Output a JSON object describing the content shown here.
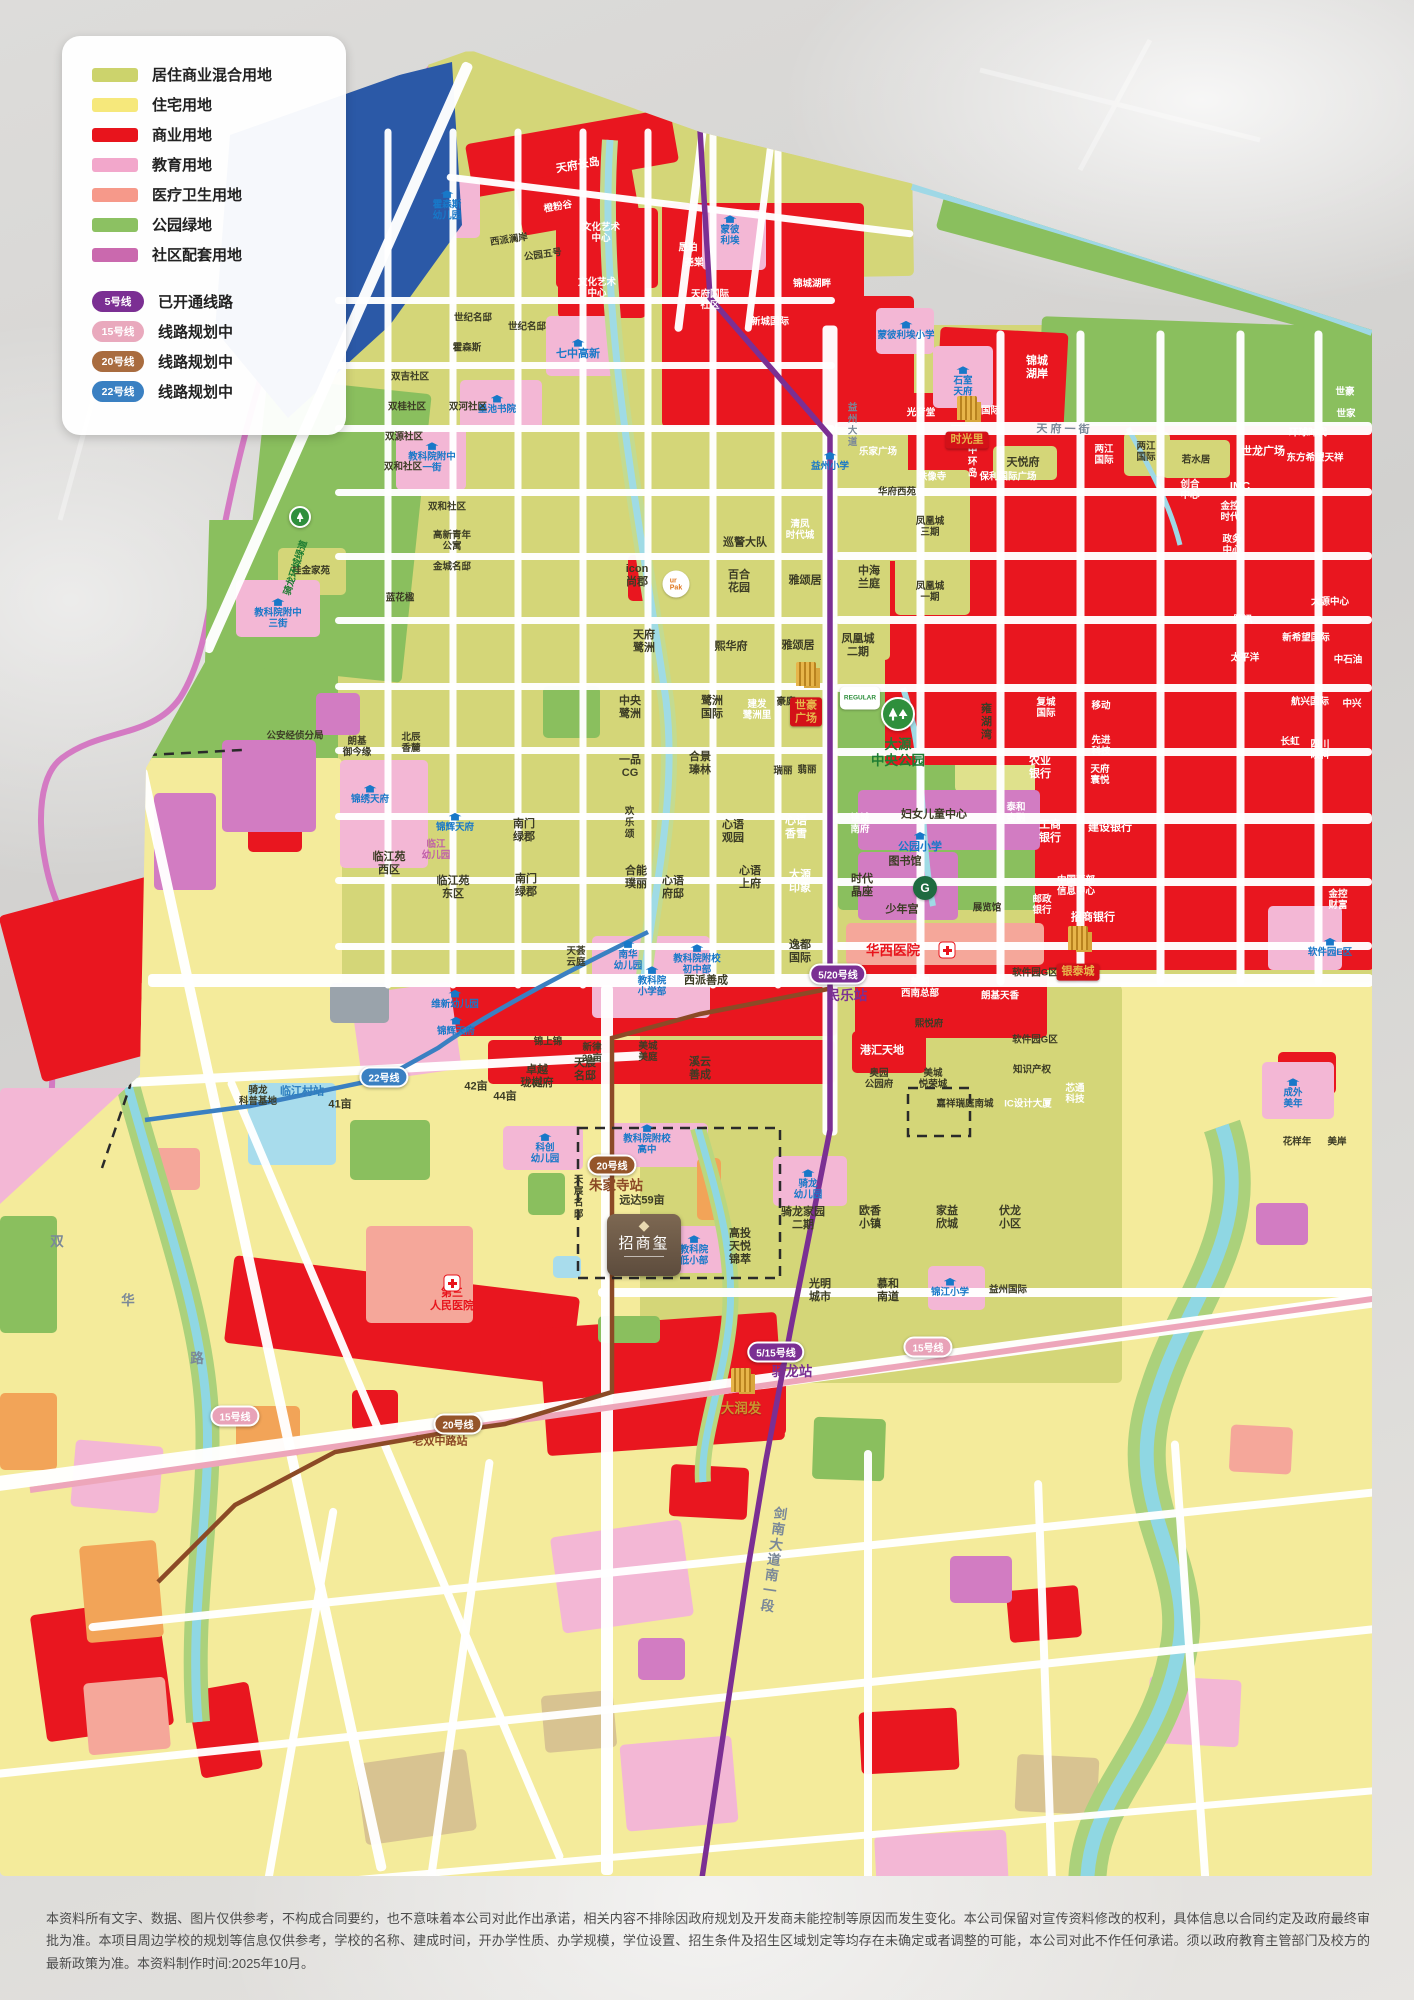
{
  "legend": {
    "land_use": [
      {
        "label": "居住商业混合用地",
        "color": "#ccd36c"
      },
      {
        "label": "住宅用地",
        "color": "#f6e87b"
      },
      {
        "label": "商业用地",
        "color": "#e8141c"
      },
      {
        "label": "教育用地",
        "color": "#f2a7cb"
      },
      {
        "label": "医疗卫生用地",
        "color": "#f6998a"
      },
      {
        "label": "公园绿地",
        "color": "#8cc162"
      },
      {
        "label": "社区配套用地",
        "color": "#ca69ae"
      }
    ],
    "metro": [
      {
        "badge": "5号线",
        "color": "#7b2f93",
        "label": "已开通线路"
      },
      {
        "badge": "15号线",
        "color": "#e9a9bd",
        "label": "线路规划中"
      },
      {
        "badge": "20号线",
        "color": "#a96c3f",
        "label": "线路规划中"
      },
      {
        "badge": "22号线",
        "color": "#3a80c2",
        "label": "线路规划中"
      }
    ]
  },
  "stations": [
    {
      "line": "5/20号线",
      "x": 838,
      "y": 974,
      "color": "#7b2f93"
    },
    {
      "line": "5/15号线",
      "x": 776,
      "y": 1352,
      "color": "#7b2f93"
    },
    {
      "line": "20号线",
      "x": 612,
      "y": 1165,
      "color": "#95552a"
    },
    {
      "line": "20号线",
      "x": 458,
      "y": 1424,
      "color": "#95552a"
    },
    {
      "line": "22号线",
      "x": 384,
      "y": 1077,
      "color": "#3a80c2"
    },
    {
      "line": "15号线",
      "x": 235,
      "y": 1416,
      "color": "#e8a2b8"
    },
    {
      "line": "15号线",
      "x": 928,
      "y": 1347,
      "color": "#e8a2b8"
    }
  ],
  "landmarks": {
    "zhaoshangxi": "招商玺",
    "zsx_dia": "◆",
    "shihao": "世豪\n广场",
    "shiguangli": "时光里",
    "yintai": "银泰城",
    "regular": "REGULAR",
    "urpak": "ur\nPak",
    "gspace": "G"
  },
  "labels": [
    {
      "t": "天府长岛",
      "x": 578,
      "y": 166,
      "c": "w",
      "r": -10
    },
    {
      "t": "橙粉谷",
      "x": 558,
      "y": 207,
      "c": "w sm",
      "r": -10
    },
    {
      "t": "文化艺术\n中心",
      "x": 601,
      "y": 233,
      "c": "w sm"
    },
    {
      "t": "文化艺术\n中心",
      "x": 597,
      "y": 288,
      "c": "w sm"
    },
    {
      "t": "西派澜岸",
      "x": 509,
      "y": 240,
      "c": "sm",
      "r": -8
    },
    {
      "t": "公园五号",
      "x": 543,
      "y": 255,
      "c": "sm",
      "r": -8
    },
    {
      "t": "霍森斯\n幼儿园",
      "x": 447,
      "y": 206,
      "c": "blue sm cap"
    },
    {
      "t": "蒙彼\n利埃",
      "x": 730,
      "y": 231,
      "c": "blue sm cap"
    },
    {
      "t": "晟珀",
      "x": 688,
      "y": 248,
      "c": "w sm"
    },
    {
      "t": "尧棠",
      "x": 694,
      "y": 263,
      "c": "w sm"
    },
    {
      "t": "天府国际\n社区",
      "x": 710,
      "y": 300,
      "c": "w sm"
    },
    {
      "t": "新城国际",
      "x": 770,
      "y": 322,
      "c": "w sm"
    },
    {
      "t": "锦城湖畔",
      "x": 812,
      "y": 284,
      "c": "w sm"
    },
    {
      "t": "石室\n天府",
      "x": 963,
      "y": 382,
      "c": "blue sm cap"
    },
    {
      "t": "锦城\n湖岸",
      "x": 1037,
      "y": 368,
      "c": "w"
    },
    {
      "t": "新城国际",
      "x": 981,
      "y": 411,
      "c": "w sm"
    },
    {
      "t": "光音堂",
      "x": 921,
      "y": 413,
      "c": "w sm"
    },
    {
      "t": "蒙彼利埃小学",
      "x": 906,
      "y": 331,
      "c": "blue sm cap"
    },
    {
      "t": "七中高新",
      "x": 578,
      "y": 350,
      "c": "blue cap"
    },
    {
      "t": "墨池书院",
      "x": 497,
      "y": 405,
      "c": "blue sm cap"
    },
    {
      "t": "教科院附中\n一街",
      "x": 432,
      "y": 458,
      "c": "blue sm cap"
    },
    {
      "t": "双吉社区",
      "x": 410,
      "y": 377,
      "c": "sm"
    },
    {
      "t": "双桂社区",
      "x": 407,
      "y": 407,
      "c": "sm"
    },
    {
      "t": "双河社区",
      "x": 468,
      "y": 407,
      "c": "sm"
    },
    {
      "t": "双源社区",
      "x": 404,
      "y": 437,
      "c": "sm"
    },
    {
      "t": "双和社区",
      "x": 403,
      "y": 467,
      "c": "sm"
    },
    {
      "t": "双和社区",
      "x": 447,
      "y": 507,
      "c": "sm"
    },
    {
      "t": "世纪名邸",
      "x": 473,
      "y": 318,
      "c": "sm"
    },
    {
      "t": "世纪名邸",
      "x": 527,
      "y": 327,
      "c": "sm"
    },
    {
      "t": "霍森斯",
      "x": 467,
      "y": 348,
      "c": "sm"
    },
    {
      "t": "巡警大队",
      "x": 745,
      "y": 543,
      "c": ""
    },
    {
      "t": "清凤\n时代城",
      "x": 800,
      "y": 530,
      "c": "w sm"
    },
    {
      "t": "桂金家苑",
      "x": 311,
      "y": 571,
      "c": "sm"
    },
    {
      "t": "高新青年\n公寓",
      "x": 452,
      "y": 541,
      "c": "sm"
    },
    {
      "t": "金城名邸",
      "x": 452,
      "y": 567,
      "c": "sm"
    },
    {
      "t": "蓝花楹",
      "x": 400,
      "y": 598,
      "c": "sm"
    },
    {
      "t": "icon\n尚郡",
      "x": 637,
      "y": 576,
      "c": ""
    },
    {
      "t": "百合\n花园",
      "x": 739,
      "y": 582,
      "c": ""
    },
    {
      "t": "雅颂居",
      "x": 805,
      "y": 581,
      "c": ""
    },
    {
      "t": "中海\n兰庭",
      "x": 869,
      "y": 578,
      "c": ""
    },
    {
      "t": "天府\n鹭洲",
      "x": 644,
      "y": 642,
      "c": ""
    },
    {
      "t": "熙华府",
      "x": 731,
      "y": 647,
      "c": ""
    },
    {
      "t": "雅颂居",
      "x": 798,
      "y": 646,
      "c": ""
    },
    {
      "t": "凤凰城\n二期",
      "x": 858,
      "y": 646,
      "c": ""
    },
    {
      "t": "华府西苑",
      "x": 897,
      "y": 492,
      "c": "sm"
    },
    {
      "t": "凤凰城\n三期",
      "x": 930,
      "y": 527,
      "c": "sm"
    },
    {
      "t": "凤凰城\n一期",
      "x": 930,
      "y": 592,
      "c": "sm"
    },
    {
      "t": "天悦府",
      "x": 1023,
      "y": 463,
      "c": ""
    },
    {
      "t": "中环岛",
      "x": 971,
      "y": 462,
      "c": "w sm vert"
    },
    {
      "t": "铁像寺",
      "x": 932,
      "y": 477,
      "c": "w sm"
    },
    {
      "t": "乐家广场",
      "x": 878,
      "y": 452,
      "c": "w sm"
    },
    {
      "t": "两江\n国际",
      "x": 1104,
      "y": 455,
      "c": "w sm"
    },
    {
      "t": "两江\n国际",
      "x": 1146,
      "y": 452,
      "c": "sm"
    },
    {
      "t": "若水居",
      "x": 1196,
      "y": 460,
      "c": "sm"
    },
    {
      "t": "世龙广场",
      "x": 1263,
      "y": 452,
      "c": "w"
    },
    {
      "t": "创合\n中心",
      "x": 1190,
      "y": 490,
      "c": "w sm"
    },
    {
      "t": "IMC",
      "x": 1240,
      "y": 487,
      "c": "w"
    },
    {
      "t": "保利国际广场",
      "x": 1008,
      "y": 477,
      "c": "w sm"
    },
    {
      "t": "环球时代",
      "x": 1308,
      "y": 433,
      "c": "w sm"
    },
    {
      "t": "东方希望天祥",
      "x": 1315,
      "y": 458,
      "c": "w sm"
    },
    {
      "t": "世豪",
      "x": 1345,
      "y": 392,
      "c": "w sm"
    },
    {
      "t": "世家",
      "x": 1346,
      "y": 414,
      "c": "w sm"
    },
    {
      "t": "金控\n时代",
      "x": 1230,
      "y": 512,
      "c": "w sm"
    },
    {
      "t": "政务\n中心",
      "x": 1232,
      "y": 545,
      "c": "w sm"
    },
    {
      "t": "腾讯",
      "x": 1243,
      "y": 620,
      "c": "w sm"
    },
    {
      "t": "太平洋",
      "x": 1245,
      "y": 658,
      "c": "w sm"
    },
    {
      "t": "大源中心",
      "x": 1330,
      "y": 602,
      "c": "w sm"
    },
    {
      "t": "新希望国际",
      "x": 1306,
      "y": 638,
      "c": "w sm"
    },
    {
      "t": "中石油",
      "x": 1348,
      "y": 660,
      "c": "w sm"
    },
    {
      "t": "航兴国际",
      "x": 1310,
      "y": 702,
      "c": "w sm"
    },
    {
      "t": "中兴",
      "x": 1352,
      "y": 704,
      "c": "w sm"
    },
    {
      "t": "复城\n国际",
      "x": 1046,
      "y": 708,
      "c": "w sm"
    },
    {
      "t": "移动",
      "x": 1101,
      "y": 706,
      "c": "w sm"
    },
    {
      "t": "先进\n科技",
      "x": 1101,
      "y": 746,
      "c": "w sm"
    },
    {
      "t": "天府\n寰悦",
      "x": 1100,
      "y": 775,
      "c": "w sm"
    },
    {
      "t": "农业\n银行",
      "x": 1040,
      "y": 768,
      "c": "w"
    },
    {
      "t": "雍湖湾",
      "x": 985,
      "y": 722,
      "c": "vert"
    },
    {
      "t": "工商\n银行",
      "x": 1050,
      "y": 832,
      "c": "w"
    },
    {
      "t": "泰和\n金融",
      "x": 1016,
      "y": 813,
      "c": "w sm"
    },
    {
      "t": "建设银行",
      "x": 1110,
      "y": 828,
      "c": "w"
    },
    {
      "t": "招商银行",
      "x": 1093,
      "y": 918,
      "c": "w"
    },
    {
      "t": "邮政\n银行",
      "x": 1042,
      "y": 905,
      "c": "w sm"
    },
    {
      "t": "中国西部\n信息中心",
      "x": 1076,
      "y": 886,
      "c": "w sm"
    },
    {
      "t": "金控\n财富",
      "x": 1338,
      "y": 900,
      "c": "w sm"
    },
    {
      "t": "长虹",
      "x": 1290,
      "y": 742,
      "c": "w sm"
    },
    {
      "t": "四川\n眼科",
      "x": 1320,
      "y": 750,
      "c": "w sm"
    },
    {
      "t": "锦城\n南府",
      "x": 860,
      "y": 824,
      "c": "w sm"
    },
    {
      "t": "妇女儿童中心",
      "x": 934,
      "y": 815,
      "c": ""
    },
    {
      "t": "公园小学",
      "x": 920,
      "y": 843,
      "c": "blue cap"
    },
    {
      "t": "图书馆",
      "x": 905,
      "y": 862,
      "c": ""
    },
    {
      "t": "少年宫",
      "x": 902,
      "y": 910,
      "c": ""
    },
    {
      "t": "展览馆",
      "x": 987,
      "y": 908,
      "c": "sm"
    },
    {
      "t": "时代\n晶座",
      "x": 862,
      "y": 886,
      "c": ""
    },
    {
      "t": "中央\n鹭洲",
      "x": 630,
      "y": 708,
      "c": ""
    },
    {
      "t": "鹭洲\n国际",
      "x": 712,
      "y": 708,
      "c": ""
    },
    {
      "t": "建发\n鹭洲里",
      "x": 757,
      "y": 710,
      "c": "w sm"
    },
    {
      "t": "豪庭",
      "x": 786,
      "y": 702,
      "c": "sm"
    },
    {
      "t": "合景\n瑧林",
      "x": 700,
      "y": 764,
      "c": ""
    },
    {
      "t": "一品\nCG",
      "x": 630,
      "y": 767,
      "c": ""
    },
    {
      "t": "瑞丽",
      "x": 783,
      "y": 771,
      "c": "sm"
    },
    {
      "t": "翡丽",
      "x": 807,
      "y": 770,
      "c": "sm"
    },
    {
      "t": "欢乐颂",
      "x": 628,
      "y": 823,
      "c": "vert sm"
    },
    {
      "t": "心语\n观园",
      "x": 733,
      "y": 832,
      "c": ""
    },
    {
      "t": "心语\n香雪",
      "x": 796,
      "y": 828,
      "c": "w"
    },
    {
      "t": "心语\n府邸",
      "x": 673,
      "y": 888,
      "c": ""
    },
    {
      "t": "合能\n璞丽",
      "x": 636,
      "y": 878,
      "c": ""
    },
    {
      "t": "心语\n上府",
      "x": 750,
      "y": 878,
      "c": ""
    },
    {
      "t": "大源\n印象",
      "x": 800,
      "y": 882,
      "c": "w"
    },
    {
      "t": "逸都\n国际",
      "x": 800,
      "y": 952,
      "c": ""
    },
    {
      "t": "西派善成",
      "x": 706,
      "y": 981,
      "c": ""
    },
    {
      "t": "天荟\n云庭",
      "x": 576,
      "y": 957,
      "c": "sm"
    },
    {
      "t": "南华\n幼儿园",
      "x": 628,
      "y": 956,
      "c": "blue sm cap"
    },
    {
      "t": "教科院附校\n初中部",
      "x": 697,
      "y": 960,
      "c": "blue sm cap"
    },
    {
      "t": "教科院\n小学部",
      "x": 652,
      "y": 982,
      "c": "blue sm cap"
    },
    {
      "t": "教科院附中\n三街",
      "x": 278,
      "y": 614,
      "c": "blue sm cap"
    },
    {
      "t": "公安经侦分局",
      "x": 295,
      "y": 736,
      "c": "sm"
    },
    {
      "t": "朗基\n御今缘",
      "x": 357,
      "y": 747,
      "c": "sm"
    },
    {
      "t": "北辰\n香麓",
      "x": 411,
      "y": 743,
      "c": "sm"
    },
    {
      "t": "锦绣天府",
      "x": 370,
      "y": 795,
      "c": "blue sm cap"
    },
    {
      "t": "锦辉天府",
      "x": 455,
      "y": 823,
      "c": "blue sm cap"
    },
    {
      "t": "临江\n幼儿园",
      "x": 436,
      "y": 850,
      "c": "pink sm"
    },
    {
      "t": "临江苑\n西区",
      "x": 389,
      "y": 864,
      "c": ""
    },
    {
      "t": "临江苑\n东区",
      "x": 453,
      "y": 888,
      "c": ""
    },
    {
      "t": "南门\n绿郡",
      "x": 524,
      "y": 831,
      "c": ""
    },
    {
      "t": "南门\n绿郡",
      "x": 526,
      "y": 886,
      "c": ""
    },
    {
      "t": "维新幼儿园",
      "x": 455,
      "y": 1000,
      "c": "blue sm cap"
    },
    {
      "t": "锦辉天府",
      "x": 456,
      "y": 1027,
      "c": "blue sm cap"
    },
    {
      "t": "美国\n西南总部",
      "x": 920,
      "y": 988,
      "c": "w sm"
    },
    {
      "t": "朗基天香",
      "x": 1000,
      "y": 996,
      "c": "w sm"
    },
    {
      "t": "软件园G区",
      "x": 1035,
      "y": 973,
      "c": "sm"
    },
    {
      "t": "软件园G区",
      "x": 1035,
      "y": 1040,
      "c": "sm"
    },
    {
      "t": "港汇天地",
      "x": 882,
      "y": 1051,
      "c": "w"
    },
    {
      "t": "熙悦府",
      "x": 929,
      "y": 1024,
      "c": "sm"
    },
    {
      "t": "奥园\n公园府",
      "x": 879,
      "y": 1079,
      "c": "sm"
    },
    {
      "t": "美城\n悦荣城",
      "x": 933,
      "y": 1079,
      "c": "sm"
    },
    {
      "t": "知识产权",
      "x": 1032,
      "y": 1070,
      "c": "sm"
    },
    {
      "t": "嘉祥瑞庭南城",
      "x": 965,
      "y": 1104,
      "c": "sm"
    },
    {
      "t": "IC设计大厦",
      "x": 1028,
      "y": 1104,
      "c": "w sm"
    },
    {
      "t": "芯通\n科技",
      "x": 1075,
      "y": 1094,
      "c": "w sm"
    },
    {
      "t": "成外\n美年",
      "x": 1293,
      "y": 1094,
      "c": "blue sm cap"
    },
    {
      "t": "软件园E区",
      "x": 1330,
      "y": 948,
      "c": "blue sm cap"
    },
    {
      "t": "花样年",
      "x": 1297,
      "y": 1142,
      "c": "sm"
    },
    {
      "t": "美岸",
      "x": 1337,
      "y": 1142,
      "c": "sm"
    },
    {
      "t": "益州小学",
      "x": 830,
      "y": 462,
      "c": "blue sm cap"
    },
    {
      "t": "骑龙\n科普基地",
      "x": 258,
      "y": 1096,
      "c": "sm"
    },
    {
      "t": "卓越\n珑樾府",
      "x": 537,
      "y": 1077,
      "c": ""
    },
    {
      "t": "天宸\n名邸",
      "x": 585,
      "y": 1070,
      "c": ""
    },
    {
      "t": "溪云\n善成",
      "x": 700,
      "y": 1069,
      "c": ""
    },
    {
      "t": "锦上锦",
      "x": 548,
      "y": 1042,
      "c": "sm"
    },
    {
      "t": "新律\n29亩",
      "x": 592,
      "y": 1053,
      "c": "sm"
    },
    {
      "t": "美城\n美庭",
      "x": 648,
      "y": 1052,
      "c": "sm"
    },
    {
      "t": "42亩",
      "x": 476,
      "y": 1087,
      "c": ""
    },
    {
      "t": "41亩",
      "x": 340,
      "y": 1105,
      "c": ""
    },
    {
      "t": "44亩",
      "x": 505,
      "y": 1097,
      "c": ""
    },
    {
      "t": "科创\n幼儿园",
      "x": 545,
      "y": 1149,
      "c": "blue sm cap"
    },
    {
      "t": "教科院附校\n高中",
      "x": 647,
      "y": 1140,
      "c": "blue sm cap"
    },
    {
      "t": "天宸名邸",
      "x": 577,
      "y": 1197,
      "c": "sm vert"
    },
    {
      "t": "远达59亩",
      "x": 642,
      "y": 1201,
      "c": ""
    },
    {
      "t": "教科院\n低小部",
      "x": 694,
      "y": 1251,
      "c": "blue sm cap"
    },
    {
      "t": "高投\n天悦\n锦萃",
      "x": 740,
      "y": 1247,
      "c": ""
    },
    {
      "t": "骑龙\n幼儿园",
      "x": 808,
      "y": 1185,
      "c": "blue sm cap"
    },
    {
      "t": "骑龙家园\n二期",
      "x": 803,
      "y": 1219,
      "c": ""
    },
    {
      "t": "欧香\n小镇",
      "x": 870,
      "y": 1218,
      "c": ""
    },
    {
      "t": "家益\n欣城",
      "x": 947,
      "y": 1218,
      "c": ""
    },
    {
      "t": "伏龙\n小区",
      "x": 1010,
      "y": 1218,
      "c": ""
    },
    {
      "t": "光明\n城市",
      "x": 820,
      "y": 1291,
      "c": ""
    },
    {
      "t": "慕和\n南道",
      "x": 888,
      "y": 1291,
      "c": ""
    },
    {
      "t": "锦江小学",
      "x": 950,
      "y": 1288,
      "c": "blue sm cap"
    },
    {
      "t": "益州国际",
      "x": 1008,
      "y": 1290,
      "c": "sm"
    },
    {
      "t": "大润发",
      "x": 741,
      "y": 1409,
      "c": "gold lg"
    },
    {
      "t": "华西医院",
      "x": 893,
      "y": 951,
      "c": "redt lg"
    },
    {
      "t": "第三\n人民医院",
      "x": 452,
      "y": 1300,
      "c": "redt"
    },
    {
      "t": "骑龙环城绿道",
      "x": 296,
      "y": 568,
      "c": "green sm",
      "r": -72
    },
    {
      "t": "大源\n中央公园",
      "x": 898,
      "y": 753,
      "c": "green lg"
    },
    {
      "t": "民乐站",
      "x": 847,
      "y": 996,
      "c": "purple lg"
    },
    {
      "t": "骑龙站",
      "x": 792,
      "y": 1372,
      "c": "purple lg"
    },
    {
      "t": "朱家寺站",
      "x": 616,
      "y": 1186,
      "c": "brown lg"
    },
    {
      "t": "老双中路站",
      "x": 440,
      "y": 1442,
      "c": "brown"
    },
    {
      "t": "临江村站",
      "x": 302,
      "y": 1092,
      "c": "teal"
    },
    {
      "t": "天 府 一 街",
      "x": 1063,
      "y": 430,
      "c": "roadlbl",
      "r": 1
    },
    {
      "t": "益州大道",
      "x": 851,
      "y": 425,
      "c": "roadlbl vert sm"
    },
    {
      "t": "剑南大道南一段",
      "x": 772,
      "y": 1560,
      "c": "roadlbl vert lg",
      "r": 8
    },
    {
      "t": "双",
      "x": 57,
      "y": 1242,
      "c": "roadlbl lg"
    },
    {
      "t": "华",
      "x": 128,
      "y": 1301,
      "c": "roadlbl lg"
    },
    {
      "t": "路",
      "x": 197,
      "y": 1359,
      "c": "roadlbl lg"
    }
  ],
  "disclaimer": "本资料所有文字、数据、图片仅供参考，不构成合同要约，也不意味着本公司对此作出承诺，相关内容不排除因政府规划及开发商未能控制等原因而发生变化。本公司保留对宣传资料修改的权利，具体信息以合同约定及政府最终审批为准。本项目周边学校的规划等信息仅供参考，学校的名称、建成时间，开办学性质、办学规模，学位设置、招生条件及招生区域划定等均存在未确定或者调整的可能，本公司对此不作任何承诺。须以政府教育主管部门及校方的最新政策为准。本资料制作时间:2025年10月。"
}
